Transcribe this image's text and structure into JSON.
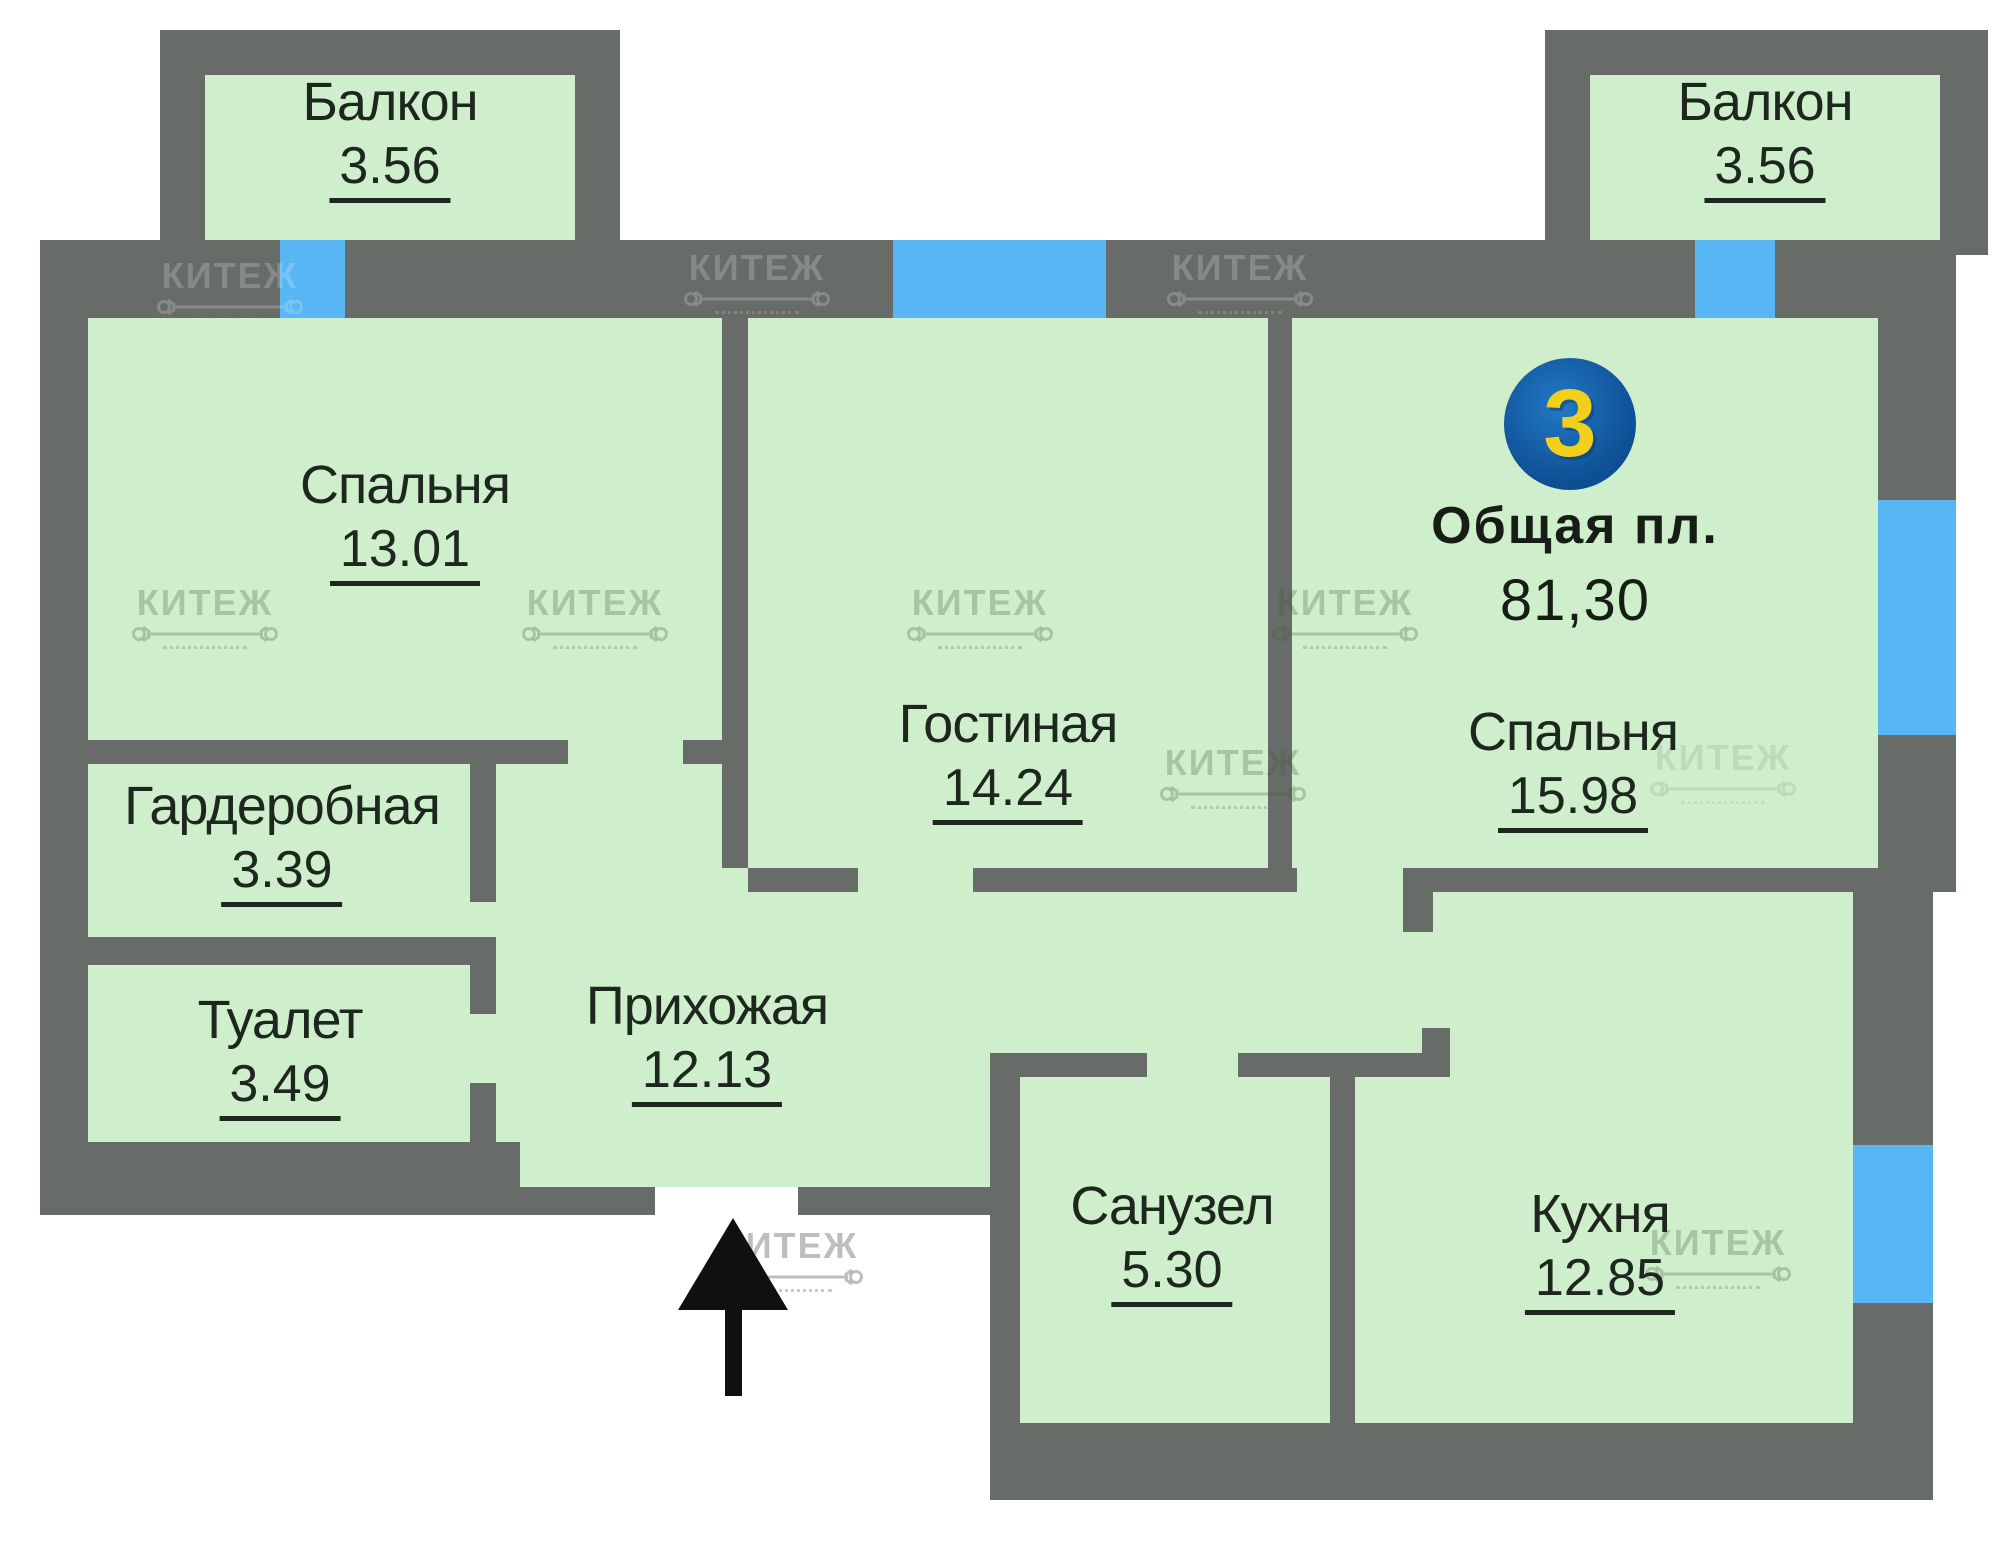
{
  "summary": {
    "unit_number": "3",
    "area_label": "Общая пл.",
    "area_value": "81,30"
  },
  "watermark": {
    "text": "КИТЕЖ"
  },
  "rooms": [
    {
      "id": "balcony-left",
      "name": "Балкон",
      "area": "3.56"
    },
    {
      "id": "bedroom-1",
      "name": "Спальня",
      "area": "13.01"
    },
    {
      "id": "wardrobe",
      "name": "Гардеробная",
      "area": "3.39"
    },
    {
      "id": "toilet",
      "name": "Туалет",
      "area": "3.49"
    },
    {
      "id": "hallway",
      "name": "Прихожая",
      "area": "12.13"
    },
    {
      "id": "living-room",
      "name": "Гостиная",
      "area": "14.24"
    },
    {
      "id": "bathroom",
      "name": "Санузел",
      "area": "5.30"
    },
    {
      "id": "kitchen",
      "name": "Кухня",
      "area": "12.85"
    },
    {
      "id": "bedroom-2",
      "name": "Спальня",
      "area": "15.98"
    },
    {
      "id": "balcony-right",
      "name": "Балкон",
      "area": "3.56"
    }
  ],
  "colors": {
    "wall": "#686c68",
    "room_fill": "#cfeecb",
    "window": "#58b6f4",
    "badge_circle": "#0e5094",
    "badge_number": "#f2cf1a",
    "label_text": "#1d271d"
  }
}
